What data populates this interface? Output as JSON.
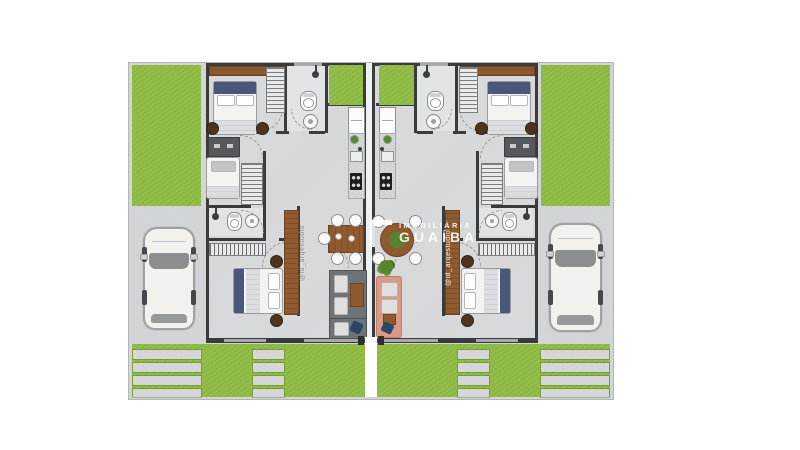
{
  "scene": {
    "description": "Top-view architectural floor plan render of twin mirrored single-story houses (duplex) with rear lawns, front driveways with parked cars, and paved front walkways",
    "background": "#ffffff"
  },
  "watermark": {
    "logo_icon": "white-corner-bracket-logo",
    "line1": "IMOBILIÁRIA",
    "line2": "GUAÍBA"
  },
  "credits": {
    "instagram_handle": "@id_arqestudio"
  },
  "colors": {
    "lawn": "#8fbc42",
    "paving_concrete": "#d2d3d5",
    "interior_floor": "#d7d8d9",
    "bathroom_floor": "#e2e3e5",
    "wall": "#3a3b3d",
    "wood_furniture": "#8e5a2e",
    "bed_accent_navy": "#49587a",
    "sofa_salmon": "#d89a84",
    "sofa_gray": "#6e7377",
    "car_body": "#f2f1ee",
    "watermark_text": "#ffffff"
  },
  "icons": {
    "toilet-icon": "oval bowl with cistern bar",
    "sink-icon": "round basin with drain dot",
    "shower-icon": "shower head dot with arm",
    "stove-icon": "black cooktop with four burners",
    "fridge-icon": "white rectangle with split line",
    "plant-icon": "green foliage cluster",
    "hanger-rack-icon": "striped closet rail",
    "door-swing-icon": "dashed quarter-circle arc",
    "car-icon": "white car top view"
  }
}
